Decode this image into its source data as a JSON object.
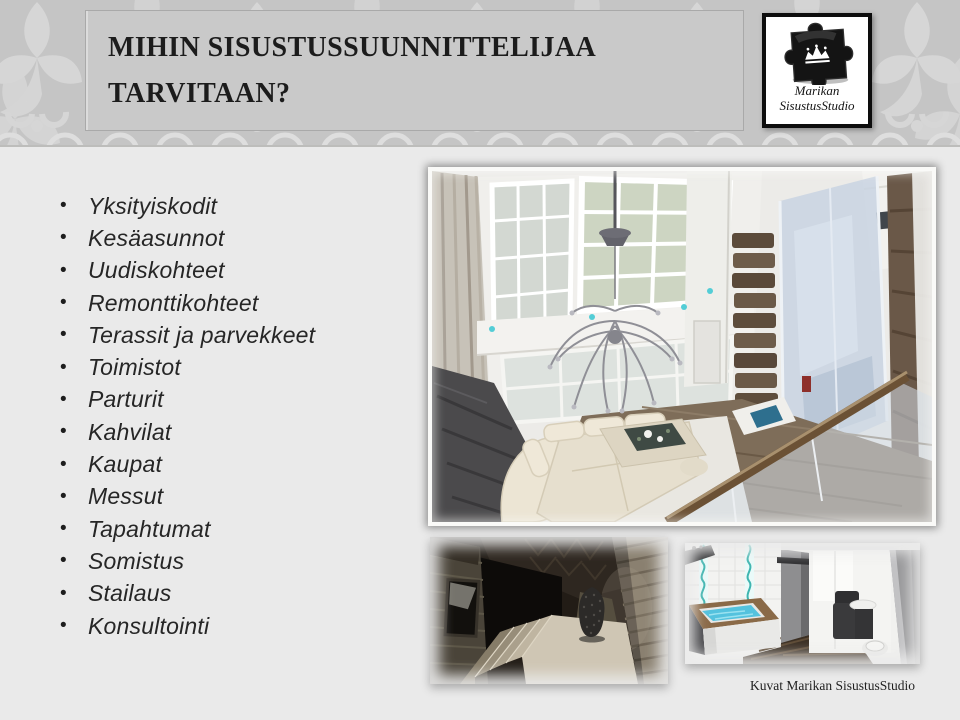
{
  "slide": {
    "title_line1": "MIHIN SISUSTUSSUUNNITTELIJAA",
    "title_line2": "TARVITAAN?",
    "caption": "Kuvat Marikan SisustusStudio"
  },
  "logo": {
    "name_line1": "Marikan",
    "name_line2": "SisustusStudio"
  },
  "list": {
    "bullet": "•",
    "items": [
      "Yksityiskodit",
      "Kesäasunnot",
      "Uudiskohteet",
      "Remonttikohteet",
      "Terassit ja parvekkeet",
      "Toimistot",
      "Parturit",
      "Kahvilat",
      "Kaupat",
      "Messut",
      "Tapahtumat",
      "Somistus",
      "Stailaus",
      "Konsultointi"
    ]
  },
  "images": {
    "main_alt": "3D render of a two-storey living room seen from the loft: tall paned windows, branch chandelier, cream corner sofa, glass balcony railing and log wall",
    "stairs_alt": "3D render of a dark log-walled staircase with beige winding steps and a patterned vase",
    "bath_alt": "3D render of a bathroom with square blue tub, turquoise wave tile strips, dark floor and dark vanity"
  },
  "colors": {
    "header_band": "#c5c5c5",
    "title_box": "#c9c9c9",
    "body_bg": "#eaeaea",
    "title_text": "#1c1c1c",
    "list_text": "#262626",
    "logo_border": "#0d0d0d",
    "tub_water": "#54c2de",
    "tile_wave": "#3fb5b0"
  }
}
